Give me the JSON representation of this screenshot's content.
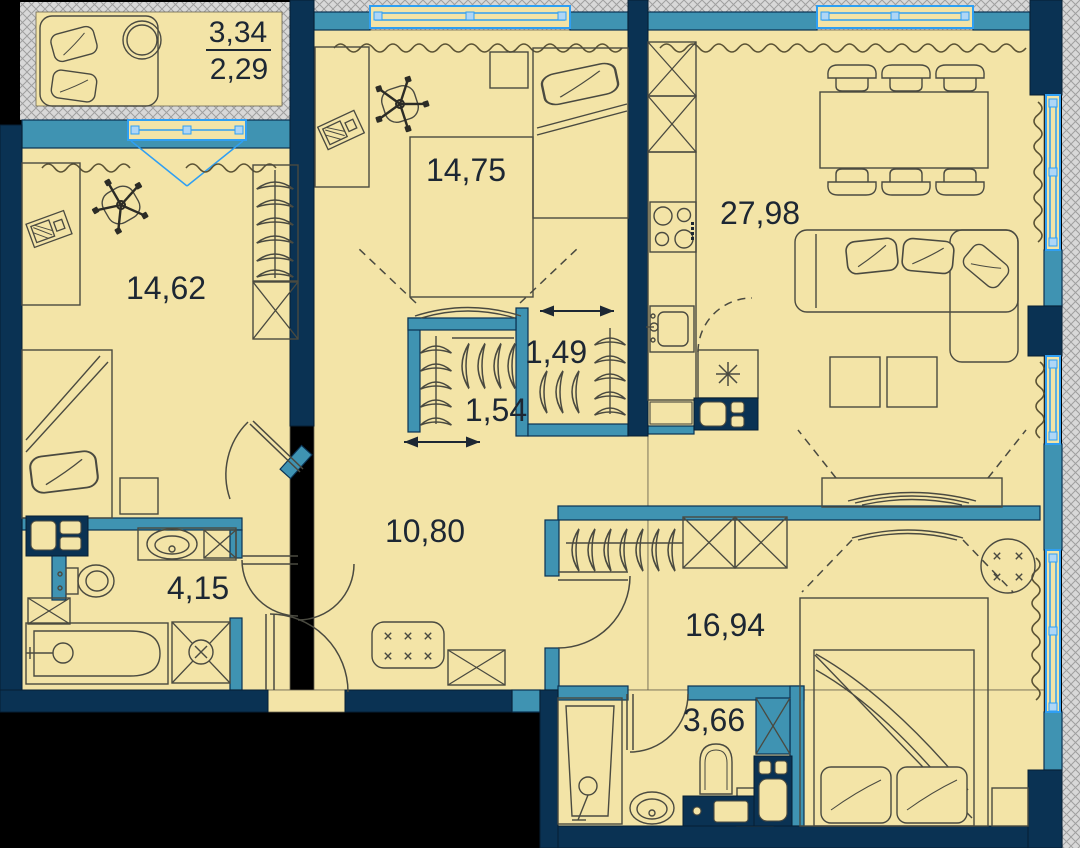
{
  "document_type": "apartment-floor-plan",
  "palette": {
    "background": "#000000",
    "floor": "#f3e4a7",
    "exterior_wall": "#0a3253",
    "partition_wall": "#3f93b2",
    "window_frame": "#2f9ff3",
    "hatch_bg": "#d8d8d8",
    "hatch_line": "#9f9f9f",
    "furniture_outline": "#4a4a40",
    "label_text": "#1d2733"
  },
  "rooms": {
    "balcony": {
      "name": "balcony",
      "area_total": "3,34",
      "area_counted": "2,29",
      "furniture": [
        "sofa",
        "round-table"
      ]
    },
    "bedroom_top": {
      "name": "bedroom",
      "area": "14,75",
      "furniture": [
        "desk",
        "laptop",
        "office-chair",
        "nightstand",
        "single-bed",
        "wardrobe-footprint",
        "tv",
        "sliding-door-arrow",
        "radiator"
      ]
    },
    "living_kitchen": {
      "name": "living-kitchen",
      "area": "27,98",
      "furniture": [
        "tall-cabinets",
        "hob",
        "kitchen-sink",
        "refrigerator",
        "dining-table",
        "chairs",
        "corner-sofa",
        "side-tables",
        "tv-console",
        "radiator"
      ]
    },
    "bedroom_left": {
      "name": "bedroom",
      "area": "14,62",
      "furniture": [
        "desk",
        "laptop",
        "office-chair",
        "wardrobe-hangers",
        "cabinet",
        "single-bed",
        "nightstand",
        "radiator"
      ]
    },
    "closet_small": {
      "name": "walk-in-closet",
      "area": "1,49",
      "furniture": [
        "hangers",
        "sliding-door-arrow"
      ]
    },
    "closet_large": {
      "name": "walk-in-closet",
      "area": "1,54",
      "furniture": [
        "hangers",
        "sliding-door-arrow"
      ]
    },
    "hallway": {
      "name": "hallway",
      "area": "10,80",
      "furniture": [
        "bench",
        "cabinet",
        "entrance-door"
      ]
    },
    "bathroom_main": {
      "name": "bathroom",
      "area": "4,15",
      "furniture": [
        "washer-dryer",
        "toilet",
        "sink",
        "cabinet",
        "bathtub",
        "shower-tray"
      ]
    },
    "bedroom_master": {
      "name": "bedroom",
      "area": "16,94",
      "furniture": [
        "wardrobe-hangers",
        "cabinets",
        "tv",
        "double-bed",
        "nightstands",
        "round-table",
        "radiator"
      ]
    },
    "bathroom_second": {
      "name": "bathroom",
      "area": "3,66",
      "furniture": [
        "shower-cabin",
        "sink",
        "toilet",
        "vanity",
        "storage-column"
      ]
    }
  }
}
